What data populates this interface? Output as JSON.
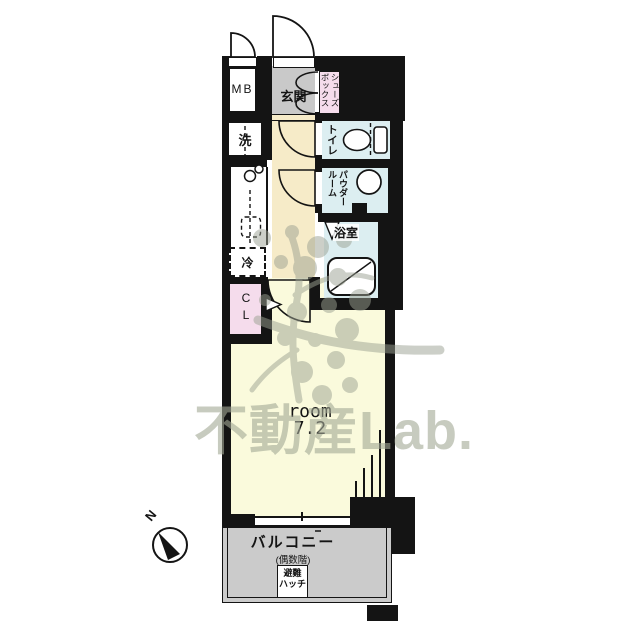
{
  "plan_type": "floor-plan",
  "watermark": {
    "brand": "不動産Lab."
  },
  "compass": {
    "north": "N"
  },
  "rooms": {
    "mb": "MB",
    "entrance": "玄関",
    "shoebox": [
      "シューズ",
      "ボックス"
    ],
    "laundry": "洗",
    "toilet": "トイレ",
    "powder": [
      "パウダー",
      "ルーム"
    ],
    "bath": "浴室",
    "fridge": "冷",
    "closet": "CL",
    "room_label": "room",
    "room_size": "7.2",
    "balcony": "バルコニー",
    "balcony_note": "(偶数階)",
    "hatch": [
      "避難",
      "ハッチ"
    ]
  },
  "colors": {
    "wall": "#141414",
    "entrance_gray": "#c9c9c9",
    "hallway_cream": "#f6ebc8",
    "room_yellow": "#fafadc",
    "wet_area_blue": "#dceef1",
    "closet_pink": "#f5dcec",
    "balcony_gray": "#cbcbcb",
    "watermark_gray": "#a3a996"
  }
}
